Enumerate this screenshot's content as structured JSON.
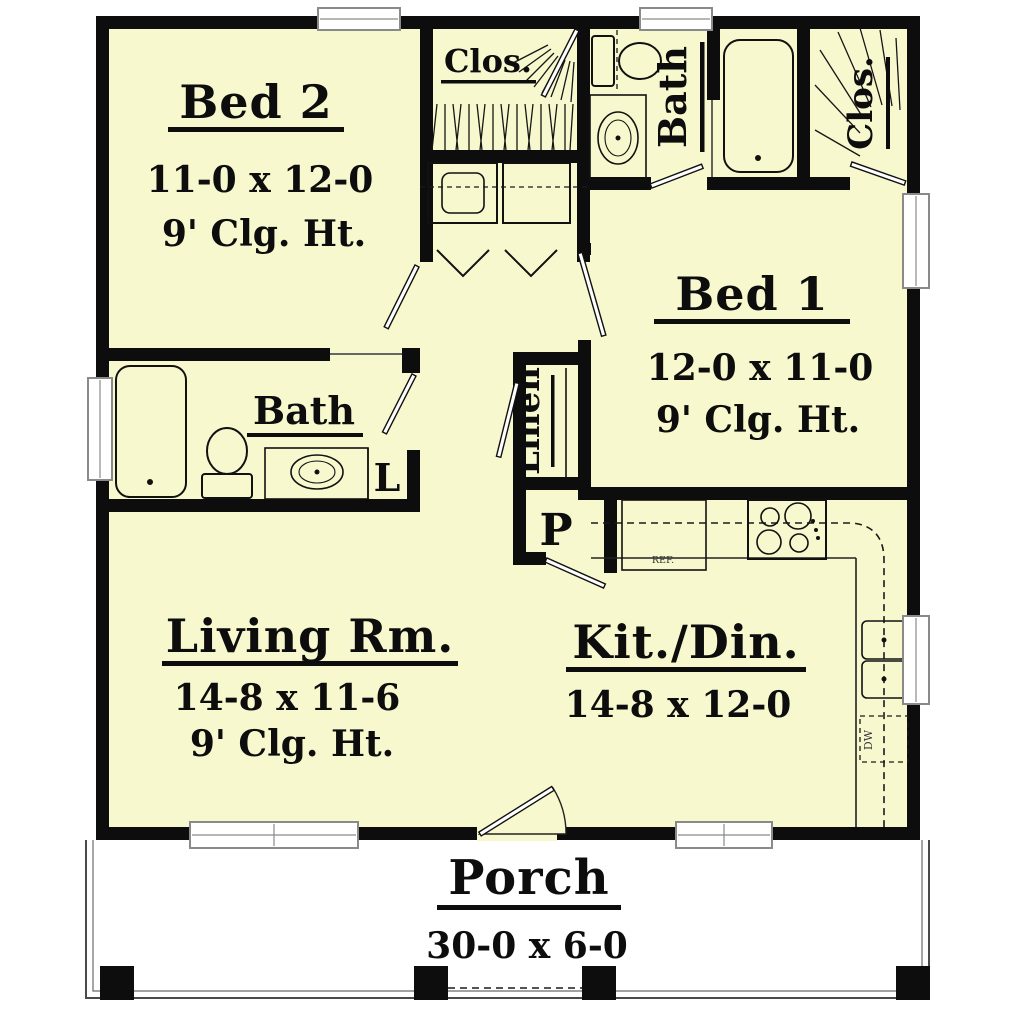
{
  "colors": {
    "floor": "#f8f8cf",
    "wall": "#0d0d0d",
    "porch_bg": "#ffffff",
    "window_frame": "#8a8a8a"
  },
  "rooms": {
    "bed2": {
      "name": "Bed 2",
      "dims": "11-0 x 12-0",
      "ceiling": "9' Clg. Ht."
    },
    "bed1": {
      "name": "Bed 1",
      "dims": "12-0 x 11-0",
      "ceiling": "9' Clg. Ht."
    },
    "living": {
      "name": "Living Rm.",
      "dims": "14-8 x 11-6",
      "ceiling": "9' Clg. Ht."
    },
    "kitchen": {
      "name": "Kit./Din.",
      "dims": "14-8 x 12-0"
    },
    "porch": {
      "name": "Porch",
      "dims": "30-0 x 6-0"
    },
    "bath_hall": {
      "name": "Bath"
    },
    "bath_main": {
      "name": "Bath"
    },
    "closet_hall": {
      "name": "Clos."
    },
    "closet_bed1": {
      "name": "Clos."
    },
    "linen": {
      "name": "Linen"
    },
    "pantry": {
      "name": "P"
    },
    "linen_cabinet": {
      "name": "L"
    }
  },
  "appliances": {
    "fridge": "REF.",
    "dishwasher": "DW"
  }
}
